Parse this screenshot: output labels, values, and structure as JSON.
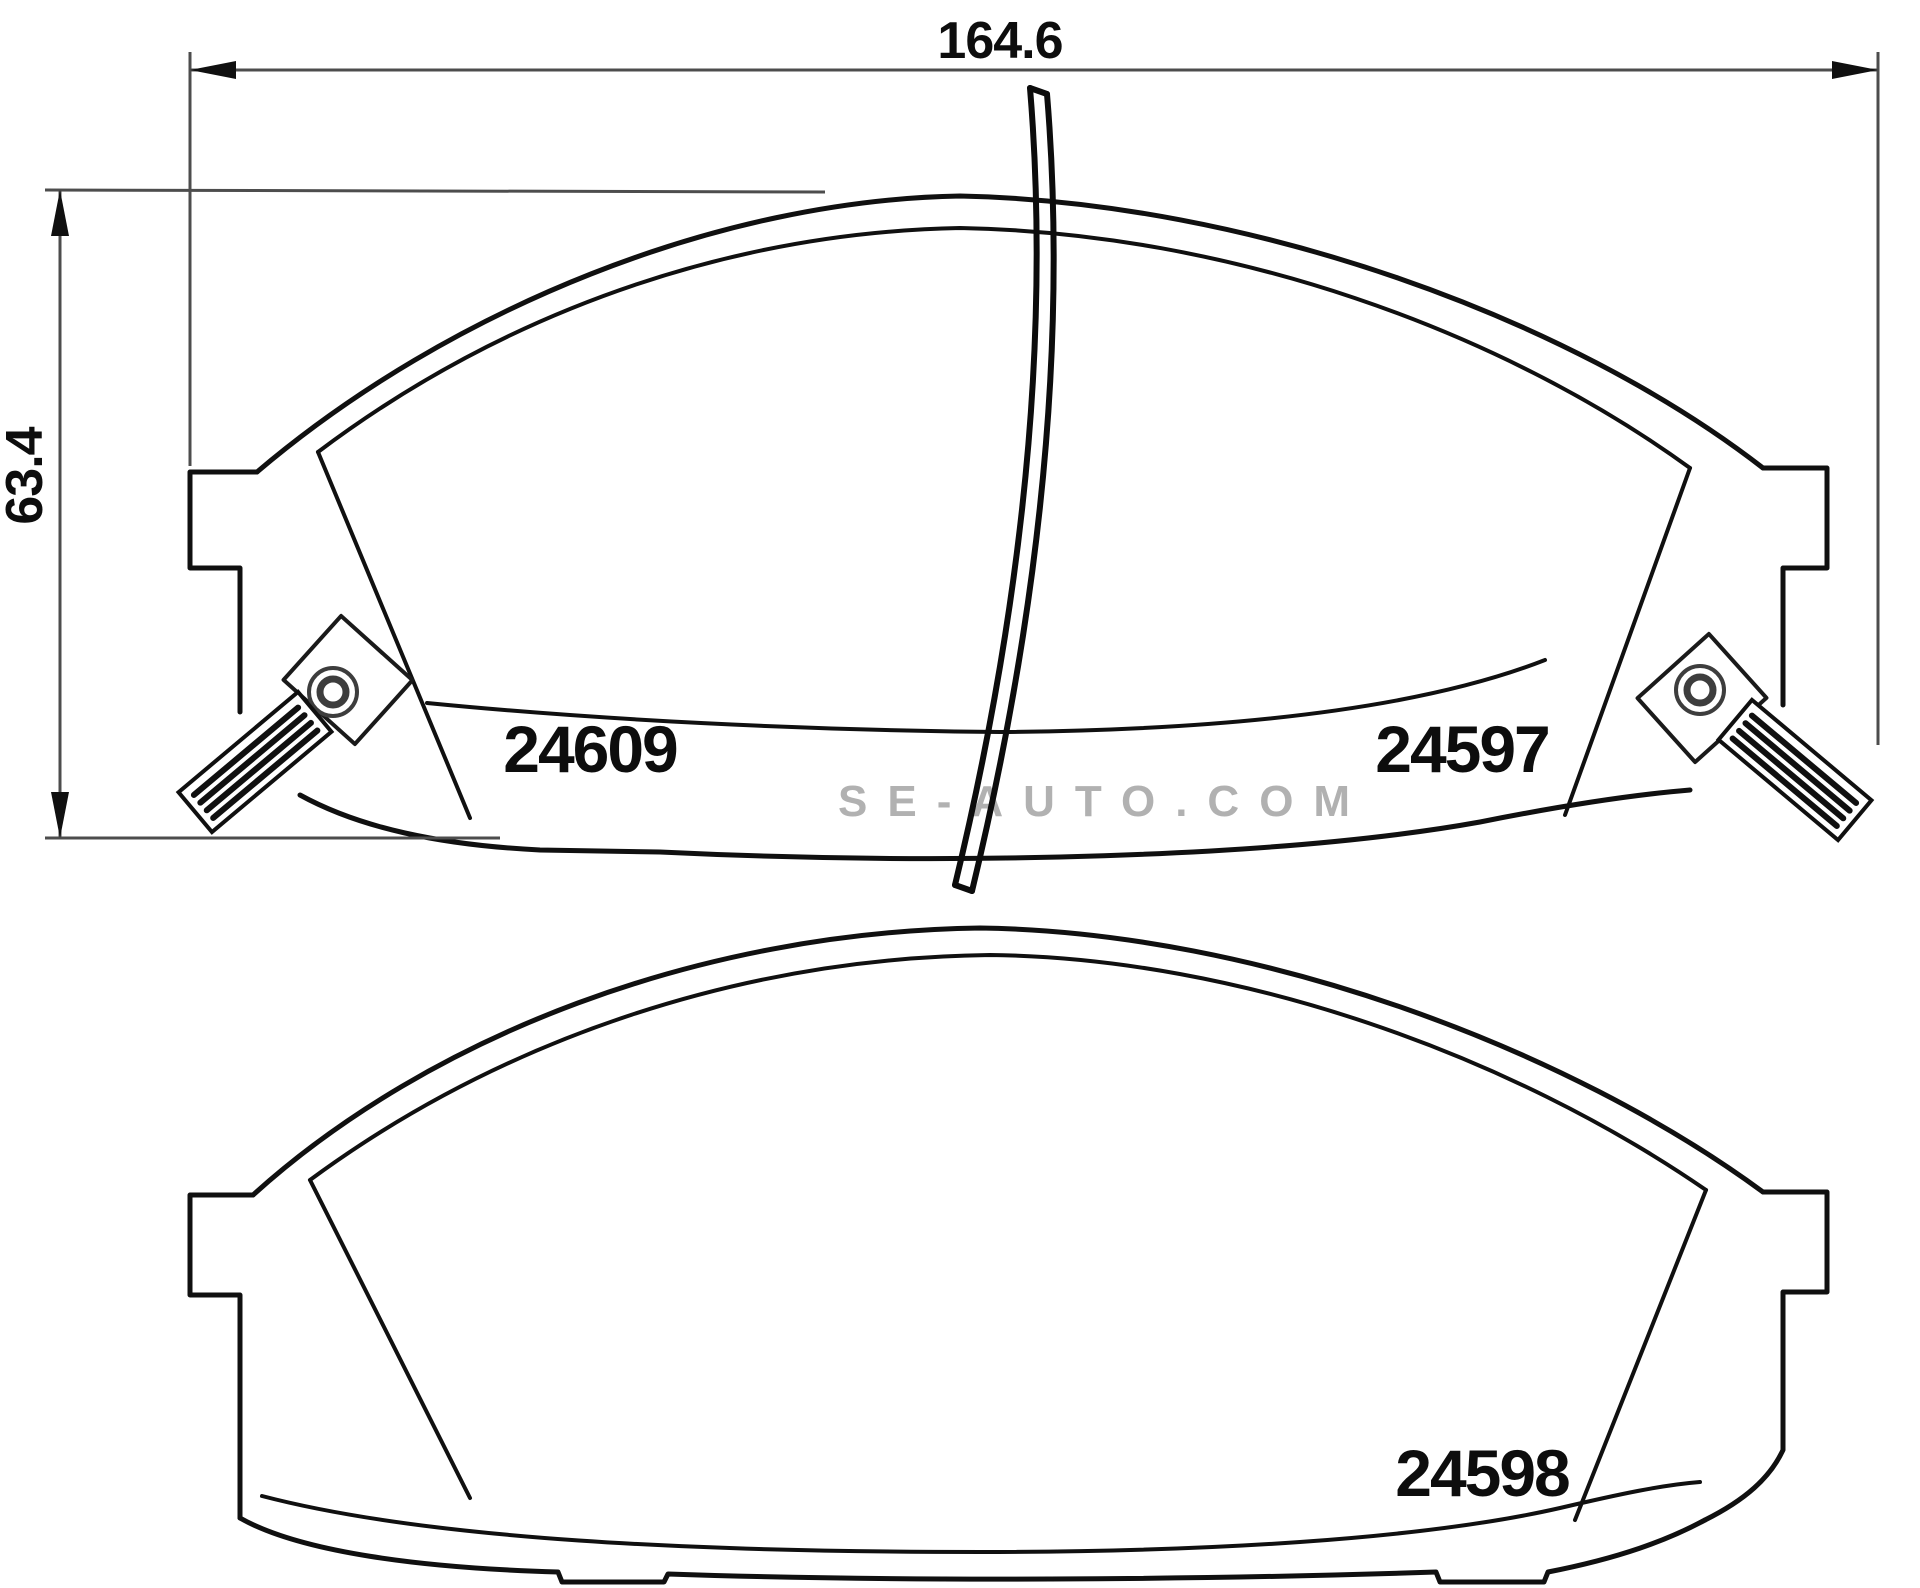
{
  "page": {
    "background": "#ffffff",
    "line_color": "#101010",
    "dim_color": "#4d4d4d"
  },
  "dimensions": {
    "width_label": "164.6",
    "height_label": "63.4"
  },
  "parts": {
    "top_left": "24609",
    "top_right": "24597",
    "bottom": "24598"
  },
  "watermark": {
    "text": "SE-AUTO.COM",
    "color": "#9e9e9e"
  }
}
